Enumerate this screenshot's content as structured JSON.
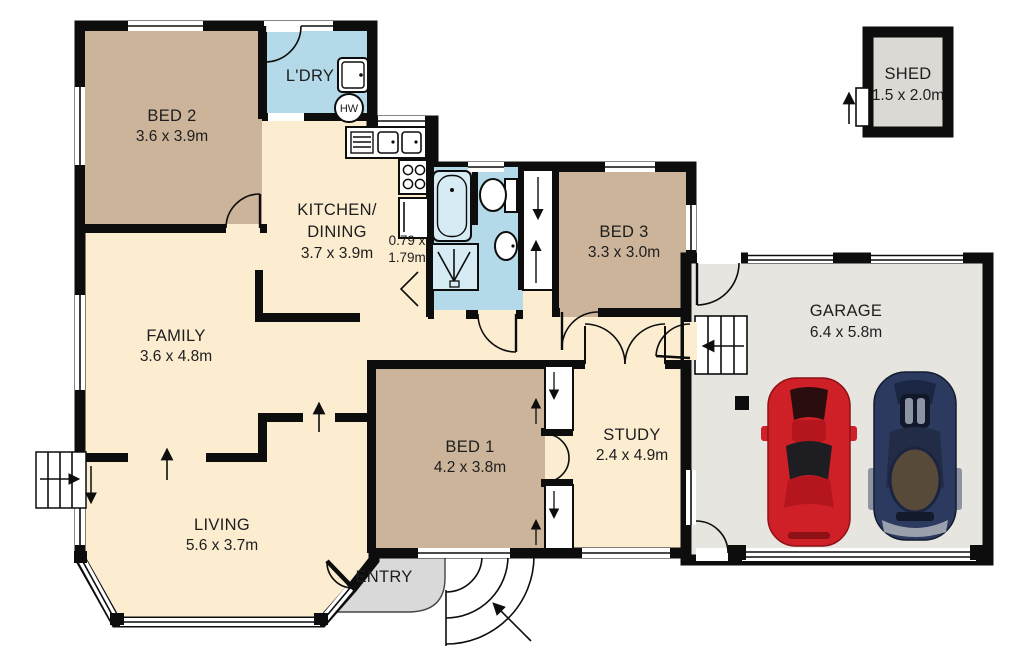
{
  "plan_title": "House floor plan",
  "rooms": {
    "bed2": {
      "name": "BED 2",
      "size": "3.6 x 3.9m"
    },
    "laundry": {
      "name": "L'DRY"
    },
    "kitchen": {
      "line1": "KITCHEN/",
      "line2": "DINING",
      "size": "3.7 x 3.9m"
    },
    "wc": {
      "size1": "0.79 x",
      "size2": "1.79m"
    },
    "bed3": {
      "name": "BED 3",
      "size": "3.3 x 3.0m"
    },
    "family": {
      "name": "FAMILY",
      "size": "3.6 x 4.8m"
    },
    "bed1": {
      "name": "BED 1",
      "size": "4.2 x 3.8m"
    },
    "study": {
      "name": "STUDY",
      "size": "2.4 x 4.9m"
    },
    "living": {
      "name": "LIVING",
      "size": "5.6 x 3.7m"
    },
    "entry": {
      "name": "ENTRY"
    },
    "garage": {
      "name": "GARAGE",
      "size": "6.4 x 5.8m"
    },
    "shed": {
      "name": "SHED",
      "size": "1.5 x 2.0m"
    }
  },
  "fixtures": {
    "hot_water": "HW"
  },
  "colors": {
    "bedroom_tan": "#cbb49a",
    "living_cream": "#fcedd1",
    "wet_area_blue": "#b4d9e8",
    "garage_grey": "#e7e5e0",
    "shed_grey": "#dbd9d4",
    "entry_grey": "#d9d9d9",
    "wall_black": "#0d0d0d",
    "car_red": "#cf2028",
    "car_blue": "#2b3a5e"
  }
}
